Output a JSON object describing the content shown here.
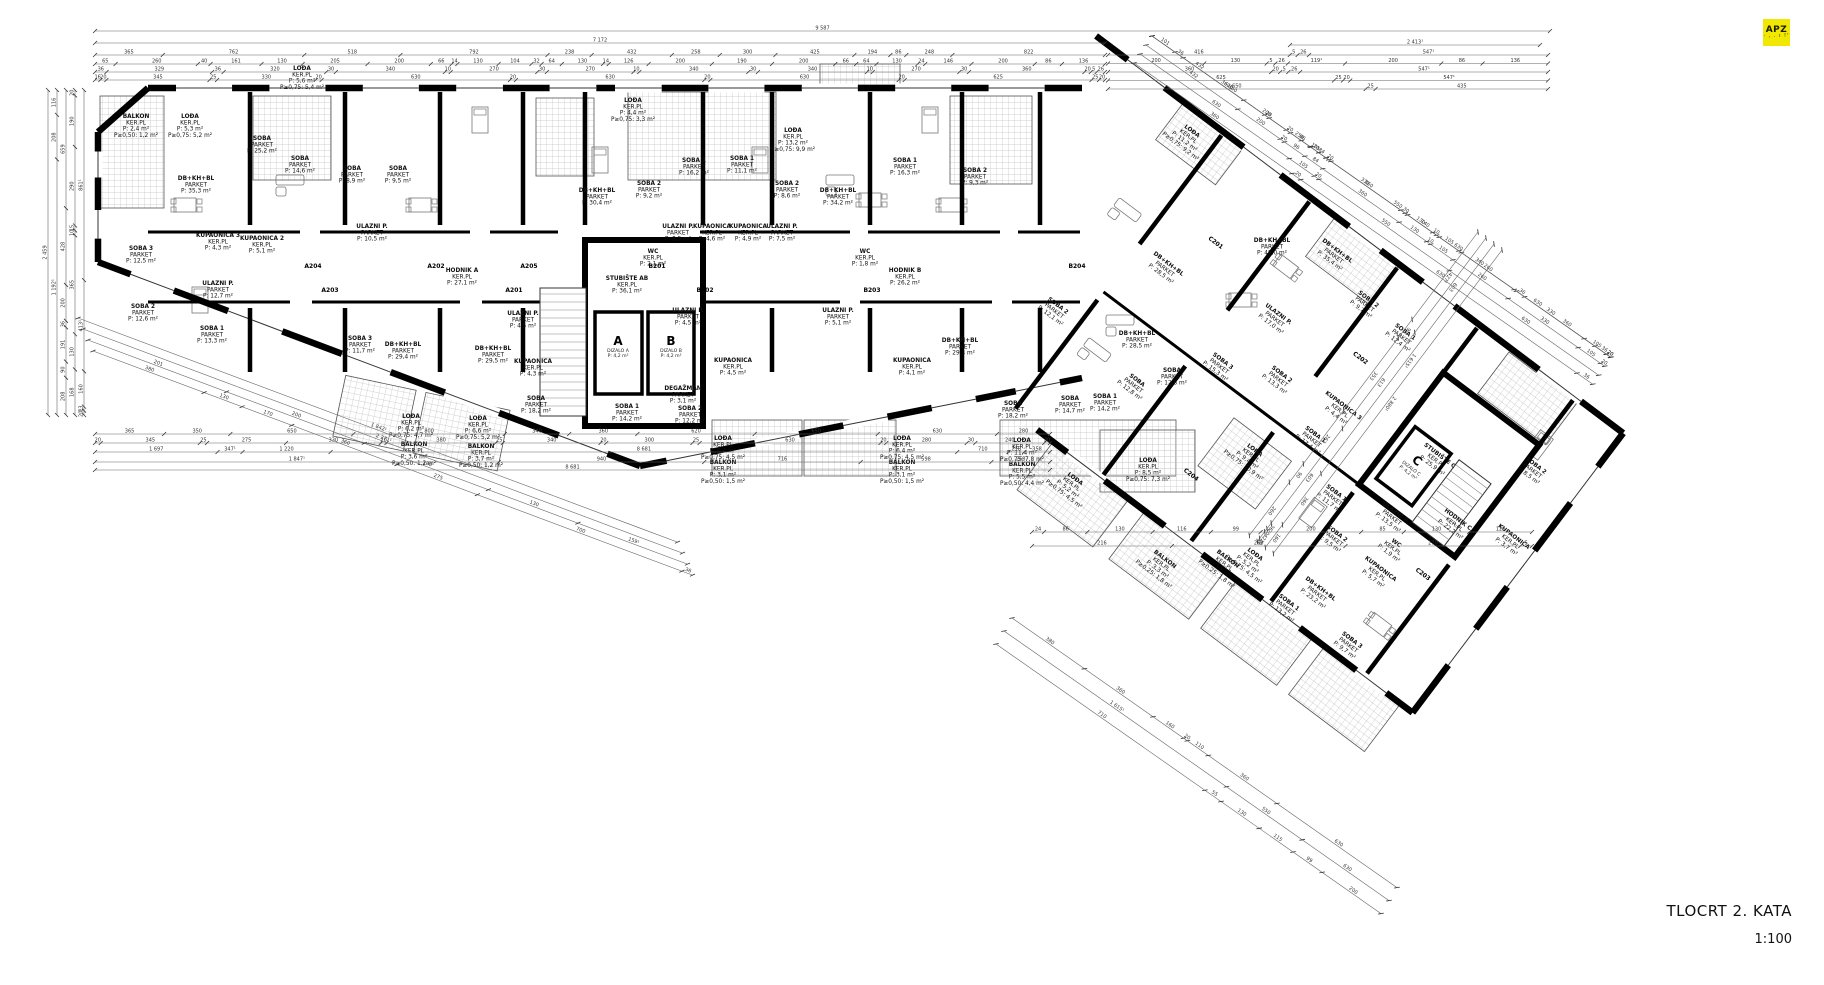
{
  "meta": {
    "title": "TLOCRT 2. KATA",
    "scale": "1:100",
    "logo": "APZ",
    "logo_sub": "· , . ı !'"
  },
  "colors": {
    "wall": "#000000",
    "thin": "#555555",
    "dim": "#666666",
    "hatch": "#c2c2c2",
    "logo_bg": "#f0e800"
  },
  "cores": {
    "a": {
      "letter": "A",
      "name": "DIZALO A",
      "area": "P: 4,2 m²"
    },
    "b": {
      "letter": "B",
      "name": "DIZALO B",
      "area": "P: 4,2 m²"
    },
    "c": {
      "letter": "C",
      "name": "DIZALO C",
      "area": "P: 4,2 m²"
    }
  },
  "unit_tags_left": [
    {
      "t": "A201",
      "x": 514,
      "y": 292
    },
    {
      "t": "A202",
      "x": 436,
      "y": 268
    },
    {
      "t": "A203",
      "x": 330,
      "y": 292
    },
    {
      "t": "A204",
      "x": 313,
      "y": 268
    },
    {
      "t": "A205",
      "x": 529,
      "y": 268
    },
    {
      "t": "B201",
      "x": 657,
      "y": 268
    },
    {
      "t": "B202",
      "x": 705,
      "y": 292
    },
    {
      "t": "B203",
      "x": 872,
      "y": 292
    },
    {
      "t": "B204",
      "x": 1077,
      "y": 268
    }
  ],
  "unit_tags_right": [
    {
      "t": "C201",
      "x": 180,
      "y": 95
    },
    {
      "t": "C202",
      "x": 365,
      "y": 100
    },
    {
      "t": "C203",
      "x": 545,
      "y": 235
    },
    {
      "t": "C204",
      "x": 300,
      "y": 295
    }
  ],
  "labels_left": [
    {
      "x": 136,
      "y": 118,
      "l": [
        "BALKON",
        "KER.PL",
        "P: 2,4 m²",
        "P≥0,50: 1,2 m²"
      ]
    },
    {
      "x": 190,
      "y": 118,
      "l": [
        "LOĐA",
        "KER.PL",
        "P: 5,3 m²",
        "P≥0,75: 5,2 m²"
      ]
    },
    {
      "x": 141,
      "y": 250,
      "l": [
        "SOBA 3",
        "PARKET",
        "P: 12,5 m²"
      ]
    },
    {
      "x": 143,
      "y": 308,
      "l": [
        "SOBA 2",
        "PARKET",
        "P: 12,6 m²"
      ]
    },
    {
      "x": 212,
      "y": 330,
      "l": [
        "SOBA 1",
        "PARKET",
        "P: 13,3 m²"
      ]
    },
    {
      "x": 196,
      "y": 180,
      "l": [
        "DB+KH+BL",
        "PARKET",
        "P: 35,3 m²"
      ]
    },
    {
      "x": 262,
      "y": 140,
      "l": [
        "SOBA",
        "PARKET",
        "P: 25,2 m²"
      ]
    },
    {
      "x": 218,
      "y": 237,
      "l": [
        "KUPAONICA 3",
        "KER.PL",
        "P: 4,3 m²"
      ]
    },
    {
      "x": 262,
      "y": 240,
      "l": [
        "KUPAONICA 2",
        "KER.PL",
        "P: 5,1 m²"
      ]
    },
    {
      "x": 218,
      "y": 285,
      "l": [
        "ULAZNI P.",
        "PARKET",
        "P: 12,7 m²"
      ]
    },
    {
      "x": 302,
      "y": 70,
      "l": [
        "LOĐA",
        "KER.PL",
        "P: 5,6 m²",
        "P≥0,75: 5,4 m²"
      ]
    },
    {
      "x": 300,
      "y": 160,
      "l": [
        "SOBA",
        "PARKET",
        "P: 14,6 m²"
      ]
    },
    {
      "x": 352,
      "y": 170,
      "l": [
        "SOBA",
        "PARKET",
        "P: 8,9 m²"
      ]
    },
    {
      "x": 398,
      "y": 170,
      "l": [
        "SOBA",
        "PARKET",
        "P: 9,5 m²"
      ]
    },
    {
      "x": 372,
      "y": 228,
      "l": [
        "ULAZNI P.",
        "PARKET",
        "P: 10,5 m²"
      ]
    },
    {
      "x": 403,
      "y": 346,
      "l": [
        "DB+KH+BL",
        "PARKET",
        "P: 29,4 m²"
      ]
    },
    {
      "x": 493,
      "y": 350,
      "l": [
        "DB+KH+BL",
        "PARKET",
        "P: 29,5 m²"
      ]
    },
    {
      "x": 597,
      "y": 192,
      "l": [
        "DB+KH+BL",
        "PARKET",
        "P: 30,4 m²"
      ]
    },
    {
      "x": 649,
      "y": 185,
      "l": [
        "SOBA 2",
        "PARKET",
        "P: 9,2 m²"
      ]
    },
    {
      "x": 694,
      "y": 162,
      "l": [
        "SOBA 1",
        "PARKET",
        "P: 16,2 m²"
      ]
    },
    {
      "x": 633,
      "y": 102,
      "l": [
        "LOĐA",
        "KER.PL",
        "P: 4,4 m²",
        "P≥0,75: 3,3 m²"
      ]
    },
    {
      "x": 793,
      "y": 132,
      "l": [
        "LOĐA",
        "KER.PL",
        "P: 13,2 m²",
        "P≥0,75: 9,9 m²"
      ]
    },
    {
      "x": 742,
      "y": 160,
      "l": [
        "SOBA 1",
        "PARKET",
        "P: 11,1 m²"
      ]
    },
    {
      "x": 787,
      "y": 185,
      "l": [
        "SOBA 2",
        "PARKET",
        "P: 8,6 m²"
      ]
    },
    {
      "x": 838,
      "y": 192,
      "l": [
        "DB+KH+BL",
        "PARKET",
        "P: 34,2 m²"
      ]
    },
    {
      "x": 678,
      "y": 228,
      "l": [
        "ULAZNI P.",
        "PARKET",
        "P: 8,5 m²"
      ]
    },
    {
      "x": 712,
      "y": 228,
      "l": [
        "KUPAONICA",
        "KER.PL",
        "P: 4,6 m²"
      ]
    },
    {
      "x": 748,
      "y": 228,
      "l": [
        "KUPAONICA",
        "KER.PL",
        "P: 4,9 m²"
      ]
    },
    {
      "x": 782,
      "y": 228,
      "l": [
        "ULAZNI P.",
        "PARKET",
        "P: 7,5 m²"
      ]
    },
    {
      "x": 462,
      "y": 272,
      "l": [
        "HODNIK A",
        "KER.PL",
        "P: 27,1 m²"
      ]
    },
    {
      "x": 627,
      "y": 280,
      "l": [
        "STUBIŠTE AB",
        "KER.PL",
        "P: 36,1 m²"
      ]
    },
    {
      "x": 905,
      "y": 272,
      "l": [
        "HODNIK B",
        "KER.PL",
        "P: 26,2 m²"
      ]
    },
    {
      "x": 523,
      "y": 315,
      "l": [
        "ULAZNI P.",
        "PARKET",
        "P: 4,5 m²"
      ]
    },
    {
      "x": 688,
      "y": 312,
      "l": [
        "ULAZNI P.",
        "PARKET",
        "P: 4,5 m²"
      ]
    },
    {
      "x": 533,
      "y": 363,
      "l": [
        "KUPAONICA",
        "KER.PL",
        "P: 4,3 m²"
      ]
    },
    {
      "x": 733,
      "y": 362,
      "l": [
        "KUPAONICA",
        "KER.PL",
        "P: 4,5 m²"
      ]
    },
    {
      "x": 683,
      "y": 390,
      "l": [
        "DEGAŽMAN",
        "PARKET",
        "P: 3,1 m²"
      ]
    },
    {
      "x": 653,
      "y": 253,
      "l": [
        "WC",
        "KER.PL",
        "P: 2,1 m²"
      ]
    },
    {
      "x": 865,
      "y": 253,
      "l": [
        "WC",
        "KER.PL",
        "P: 1,8 m²"
      ]
    },
    {
      "x": 536,
      "y": 400,
      "l": [
        "SOBA",
        "PARKET",
        "P: 18,2 m²"
      ]
    },
    {
      "x": 627,
      "y": 408,
      "l": [
        "SOBA 1",
        "PARKET",
        "P: 14,2 m²"
      ]
    },
    {
      "x": 690,
      "y": 410,
      "l": [
        "SOBA 2",
        "PARKET",
        "P: 12,2 m²"
      ]
    },
    {
      "x": 360,
      "y": 340,
      "l": [
        "SOBA 3",
        "PARKET",
        "P: 11,7 m²"
      ]
    },
    {
      "x": 1013,
      "y": 405,
      "l": [
        "SOBA",
        "PARKET",
        "P: 18,2 m²"
      ]
    },
    {
      "x": 1105,
      "y": 398,
      "l": [
        "SOBA 1",
        "PARKET",
        "P: 14,2 m²"
      ]
    },
    {
      "x": 905,
      "y": 162,
      "l": [
        "SOBA 1",
        "PARKET",
        "P: 16,3 m²"
      ]
    },
    {
      "x": 975,
      "y": 172,
      "l": [
        "SOBA 2",
        "PARKET",
        "P: 9,3 m²"
      ]
    },
    {
      "x": 912,
      "y": 362,
      "l": [
        "KUPAONICA",
        "KER.PL",
        "P: 4,1 m²"
      ]
    },
    {
      "x": 960,
      "y": 342,
      "l": [
        "DB+KH+BL",
        "PARKET",
        "P: 29,4 m²"
      ]
    },
    {
      "x": 838,
      "y": 312,
      "l": [
        "ULAZNI P.",
        "PARKET",
        "P: 5,1 m²"
      ]
    },
    {
      "x": 723,
      "y": 440,
      "l": [
        "LOĐA",
        "KER.PL",
        "P: 6,4 m²",
        "P≥0,75: 4,5 m²"
      ]
    },
    {
      "x": 723,
      "y": 464,
      "l": [
        "BALKON",
        "KER.PL",
        "P: 3,1 m²",
        "P≥0,50: 1,5 m²"
      ]
    },
    {
      "x": 902,
      "y": 440,
      "l": [
        "LOĐA",
        "KER.PL",
        "P: 6,4 m²",
        "P≥0,75: 4,5 m²"
      ]
    },
    {
      "x": 902,
      "y": 464,
      "l": [
        "BALKON",
        "KER.PL",
        "P: 3,1 m²",
        "P≥0,50: 1,5 m²"
      ]
    },
    {
      "x": 1022,
      "y": 442,
      "l": [
        "LOĐA",
        "KER.PL",
        "P: 11,4 m²",
        "P≥0,75: 7,8 m²"
      ]
    },
    {
      "x": 1022,
      "y": 466,
      "l": [
        "BALKON",
        "KER.PL",
        "P: 5,5 m²",
        "P≥0,50: 4,4 m²"
      ]
    },
    {
      "x": 411,
      "y": 418,
      "l": [
        "LOĐA",
        "KER.PL",
        "P: 6,2 m²",
        "P≥0,75: 4,7 m²"
      ]
    },
    {
      "x": 414,
      "y": 446,
      "l": [
        "BALKON",
        "KER.PL",
        "P: 3,6 m²",
        "P≥0,50: 1,2 m²"
      ]
    },
    {
      "x": 478,
      "y": 420,
      "l": [
        "LOĐA",
        "KER.PL",
        "P: 6,6 m²",
        "P≥0,75: 5,2 m²"
      ]
    },
    {
      "x": 481,
      "y": 448,
      "l": [
        "BALKON",
        "KER.PL",
        "P: 3,7 m²",
        "P≥0,50: 1,2 m²"
      ]
    },
    {
      "x": 1272,
      "y": 242,
      "l": [
        "DB+KH+BL",
        "PARKET",
        "P: 48,0 m²"
      ]
    },
    {
      "x": 1137,
      "y": 335,
      "l": [
        "DB+KH+BL",
        "PARKET",
        "P: 28,5 m²"
      ]
    },
    {
      "x": 1172,
      "y": 372,
      "l": [
        "SOBA",
        "PARKET",
        "P: 12,8 m²"
      ]
    },
    {
      "x": 1070,
      "y": 400,
      "l": [
        "SOBA",
        "PARKET",
        "P: 14,7 m²"
      ]
    },
    {
      "x": 1148,
      "y": 462,
      "l": [
        "LOĐA",
        "KER.PL",
        "P: 8,5 m²",
        "P≥0,75: 7,3 m²"
      ]
    }
  ],
  "labels_right": [
    {
      "x": 94,
      "y": 20,
      "l": [
        "LOĐA",
        "KER.PL",
        "P: 11,2 m²",
        "P≥0,75: 9,2 m²"
      ]
    },
    {
      "x": 282,
      "y": 28,
      "l": [
        "DB+KH+BL",
        "PARKET",
        "P: 35,4 m²"
      ]
    },
    {
      "x": 336,
      "y": 48,
      "l": [
        "SOBA 2",
        "PARKET",
        "P: 9,7 m²"
      ]
    },
    {
      "x": 385,
      "y": 52,
      "l": [
        "SOBA 1",
        "PARKET",
        "P: 12,4 m²"
      ]
    },
    {
      "x": 273,
      "y": 114,
      "l": [
        "ULAZNI P.",
        "PARKET",
        "P: 17,0 m²"
      ]
    },
    {
      "x": 257,
      "y": 185,
      "l": [
        "SOBA 3",
        "PARKET",
        "P: 15,3 m²"
      ]
    },
    {
      "x": 312,
      "y": 160,
      "l": [
        "SOBA 2",
        "PARKET",
        "P: 13,3 m²"
      ]
    },
    {
      "x": 375,
      "y": 188,
      "l": [
        "SOBA 1",
        "PARKET",
        "P: 17,4 m²"
      ]
    },
    {
      "x": 380,
      "y": 148,
      "l": [
        "KUPAONICA 3",
        "KER.PL",
        "P: 4,4 m²"
      ]
    },
    {
      "x": 336,
      "y": 237,
      "l": [
        "LOĐA",
        "KER.PL",
        "P: 9,4 m²",
        "P≥0,75: 10,9 m²"
      ]
    },
    {
      "x": 427,
      "y": 222,
      "l": [
        "SOBA 1",
        "PARKET",
        "P: 11,7 m²"
      ]
    },
    {
      "x": 452,
      "y": 254,
      "l": [
        "SOBA 2",
        "PARKET",
        "P: 9,5 m²"
      ]
    },
    {
      "x": 472,
      "y": 308,
      "l": [
        "DB+KH+BL",
        "PARKET",
        "P: 23,2 m²"
      ]
    },
    {
      "x": 508,
      "y": 256,
      "l": [
        "KUPAONICA",
        "KER.PL",
        "P: 5,7 m²"
      ]
    },
    {
      "x": 505,
      "y": 226,
      "l": [
        "WC",
        "KER.PL",
        "P: 1,9 m²"
      ]
    },
    {
      "x": 486,
      "y": 202,
      "l": [
        "ULAZNI P.",
        "PARKET",
        "P: 13,5 m²"
      ]
    },
    {
      "x": 487,
      "y": 130,
      "l": [
        "STUBIŠTE C",
        "KER.PL",
        "P: 25,9 m²"
      ]
    },
    {
      "x": 540,
      "y": 170,
      "l": [
        "HODNIK C",
        "KER.PL",
        "P: 22,2 m²"
      ]
    },
    {
      "x": 399,
      "y": 320,
      "l": [
        "LOĐA",
        "KER.PL",
        "P: 5,2 m²",
        "P≥0,75: 4,5 m²"
      ]
    },
    {
      "x": 380,
      "y": 340,
      "l": [
        "BALKON",
        "KER.PL",
        "P: 3,5 m²",
        "P≥0,25: 1,8 m²"
      ]
    },
    {
      "x": 200,
      "y": 252,
      "l": [
        "SOBA",
        "PARKET",
        "P: 12,8 m²"
      ]
    },
    {
      "x": 210,
      "y": 368,
      "l": [
        "LOĐA",
        "KER.PL",
        "P: 5,2 m²",
        "P≥0,75: 4,5 m²"
      ]
    },
    {
      "x": 330,
      "y": 378,
      "l": [
        "BALKON",
        "KER.PL",
        "P: 3,3 m²",
        "P≥0,25: 1,8 m²"
      ]
    },
    {
      "x": 455,
      "y": 338,
      "l": [
        "SOBA 1",
        "PARKET",
        "P: 13,2 m²"
      ]
    },
    {
      "x": 528,
      "y": 330,
      "l": [
        "SOBA 3",
        "PARKET",
        "P: 9,7 m²"
      ]
    },
    {
      "x": 155,
      "y": 140,
      "l": [
        "DB+KH+BL",
        "PARKET",
        "P: 28,5 m²"
      ]
    },
    {
      "x": 92,
      "y": 240,
      "l": [
        "SOBA 2",
        "PARKET",
        "P: 12,1 m²"
      ]
    },
    {
      "x": 570,
      "y": 80,
      "l": [
        "SOBA 2",
        "PARKET",
        "P: 8,5 m²"
      ]
    },
    {
      "x": 595,
      "y": 150,
      "l": [
        "KUPAONICA",
        "KER.PL",
        "P: 3,7 m²"
      ]
    }
  ],
  "dims": {
    "top_rows": [
      [
        "9 587"
      ],
      [
        "7 172"
      ],
      [
        "365",
        "762",
        "518",
        "792",
        "238",
        "432",
        "258",
        "300",
        "425",
        "194",
        "86",
        "248",
        "822"
      ],
      [
        "65",
        "260",
        "40",
        "161",
        "130",
        "205",
        "200",
        "66",
        "14",
        "130",
        "104",
        "32",
        "64",
        "130",
        "14",
        "126",
        "200",
        "190",
        "200",
        "66",
        "64",
        "130",
        "24",
        "146",
        "200",
        "86",
        "136"
      ],
      [
        "36",
        "329",
        "36",
        "320",
        "30",
        "340",
        "10",
        "270",
        "30",
        "270",
        "10",
        "340",
        "30",
        "340",
        "10",
        "270",
        "30",
        "360",
        "20",
        "5",
        "26"
      ],
      [
        "16",
        "20",
        "345",
        "25",
        "330",
        "20",
        "630",
        "20",
        "630",
        "20",
        "630",
        "20",
        "625",
        "25",
        "20"
      ]
    ],
    "right_rows": [
      [
        "416",
        "5",
        "26",
        "547¹"
      ],
      [
        "200",
        "130",
        "5",
        "26",
        "119¹",
        "200",
        "86",
        "136"
      ],
      [
        "360",
        "20",
        "5",
        "26",
        "547¹"
      ],
      [
        "625",
        "25",
        "20",
        "547¹"
      ],
      [
        "650",
        "25",
        "435"
      ]
    ],
    "top_right_overall": "2 413¹",
    "ne_rows": [
      [
        "101",
        "36",
        "360",
        "20",
        "250",
        "330",
        "30",
        "140",
        "340",
        "36",
        "360",
        "20"
      ],
      [
        "432",
        "200",
        "20",
        "96",
        "84",
        "360",
        "130",
        "10",
        "105",
        "260",
        "330",
        "105",
        "20"
      ],
      [
        "630",
        "105",
        "20",
        "550",
        "630"
      ],
      [
        "360",
        "20",
        "630",
        "36"
      ]
    ],
    "bottom_rows": [
      [
        "365",
        "350",
        "650",
        "800",
        "340",
        "360",
        "620",
        "650",
        "630",
        "280"
      ],
      [
        "20",
        "345",
        "25",
        "275",
        "330",
        "20",
        "380",
        "25",
        "340",
        "20",
        "300",
        "25",
        "630",
        "20",
        "280",
        "30",
        "240",
        "20"
      ],
      [
        "1 697",
        "347¹",
        "1 220",
        "8 681",
        "710",
        "218",
        "358"
      ],
      [
        "1 847¹",
        "940",
        "716",
        "598",
        "268"
      ],
      [
        "8 681"
      ]
    ],
    "left_col": [
      [
        "2 459"
      ],
      [
        "1 192¹",
        "208",
        "116"
      ],
      [
        "208",
        "90",
        "191",
        "36",
        "200",
        "428",
        "659"
      ],
      [
        "168",
        "130",
        "365",
        "10",
        "15",
        "290",
        "190",
        "20"
      ],
      [
        "20¹",
        "13",
        "160",
        "413¹",
        "861¹"
      ]
    ],
    "diag_bl": [
      [
        "1 842¹"
      ],
      [
        "2 271¹"
      ],
      [
        "201",
        "200",
        "180",
        "130",
        "159¹"
      ],
      [
        "380",
        "130",
        "170",
        "360",
        "275",
        "700",
        "36"
      ]
    ],
    "se_rows": [
      [
        "427¹",
        "90",
        "353",
        "262",
        "90",
        "260"
      ],
      [
        "603",
        "613",
        "603",
        "36",
        "20",
        "42",
        "20"
      ],
      [
        "1 615¹",
        "360",
        "160"
      ],
      [
        "2 880¹"
      ]
    ],
    "sw_rows": [
      [
        "380",
        "360",
        "160",
        "20",
        "110",
        "360",
        "630"
      ],
      [
        "1 615¹",
        "550",
        "630"
      ],
      [
        "710",
        "55",
        "130",
        "115",
        "99",
        "200"
      ]
    ],
    "bottom_center_rows": [
      [
        "24",
        "86",
        "130",
        "116",
        "99",
        "200",
        "85",
        "130",
        "125"
      ],
      [
        "216",
        "268",
        "270",
        "5"
      ]
    ]
  }
}
